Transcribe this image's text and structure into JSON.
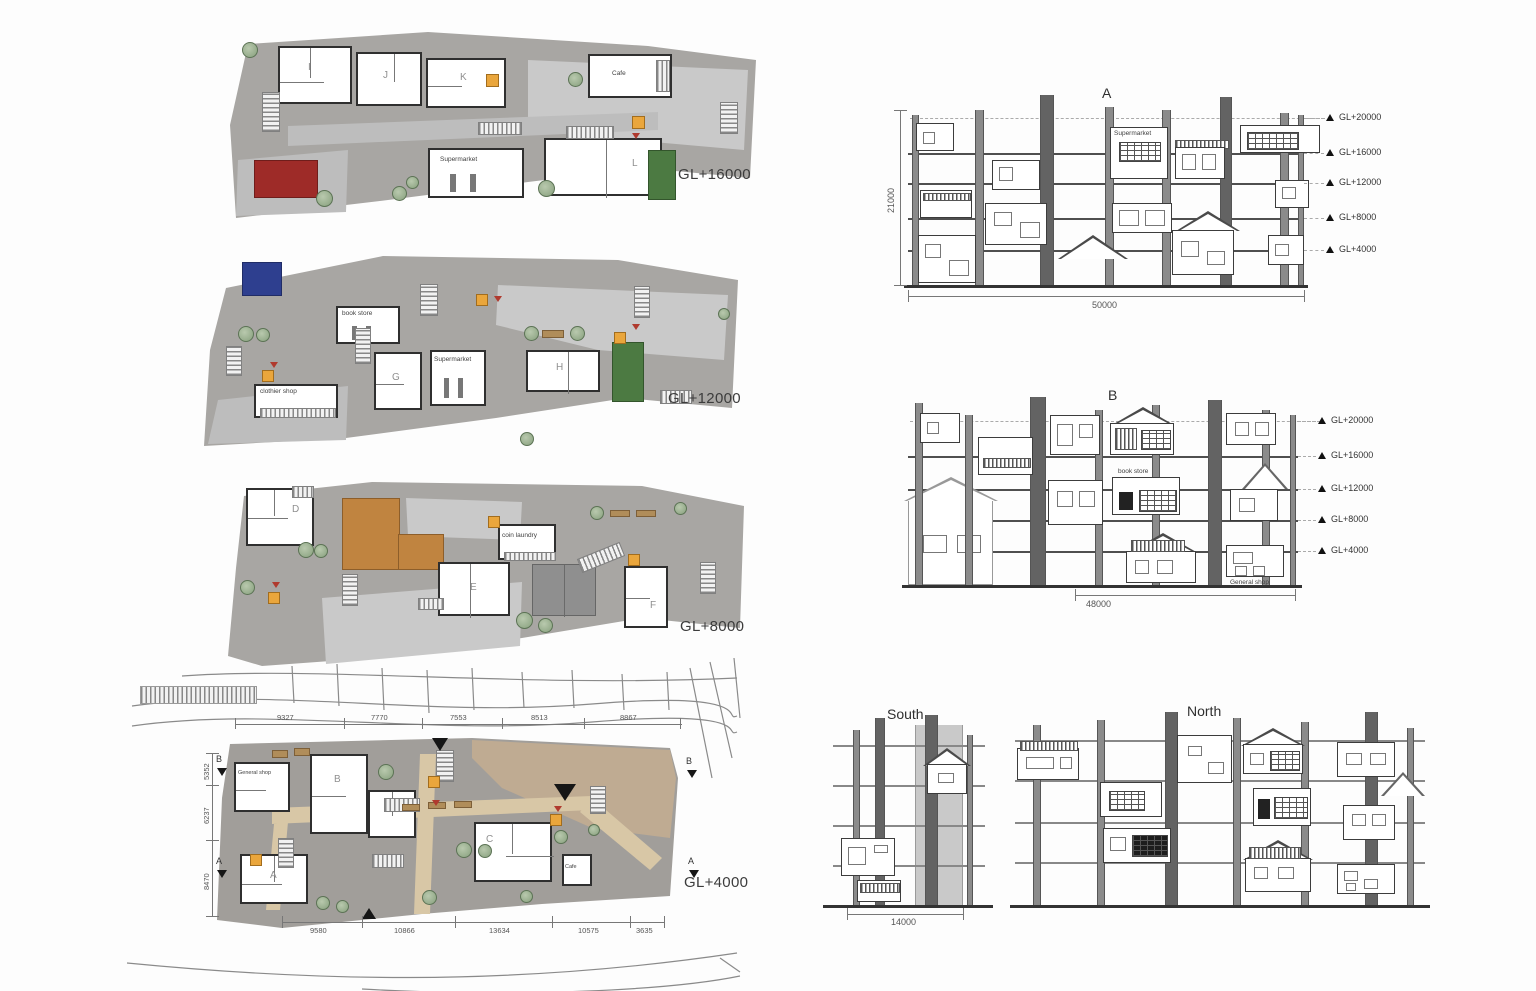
{
  "plans": {
    "gl16000": {
      "label": "GL+16000",
      "units": [
        "I",
        "J",
        "K",
        "L"
      ],
      "cafe": "Cafe",
      "supermarket": "Supermarket"
    },
    "gl12000": {
      "label": "GL+12000",
      "units": [
        "G",
        "H"
      ],
      "supermarket": "Supermarket",
      "book_store": "book store",
      "shop": "clothier shop"
    },
    "gl8000": {
      "label": "GL+8000",
      "units": [
        "D",
        "E",
        "F"
      ],
      "laundry": "coin laundry"
    },
    "gl4000": {
      "label": "GL+4000",
      "units": [
        "A",
        "B",
        "C"
      ],
      "cafe": "Cafe",
      "shop": "General shop",
      "dims_top": [
        "9327",
        "7770",
        "7553",
        "8513",
        "8867"
      ],
      "dims_bottom": [
        "9580",
        "10866",
        "13634",
        "10575",
        "3635"
      ],
      "dims_left": [
        "5352",
        "6237",
        "8470"
      ],
      "markers": {
        "b": "B",
        "a": "A"
      }
    }
  },
  "sections": {
    "a": {
      "title": "A",
      "height_dim": "21000",
      "width_dim": "50000",
      "levels": [
        "GL+20000",
        "GL+16000",
        "GL+12000",
        "GL+8000",
        "GL+4000"
      ],
      "supermarket": "Supermarket"
    },
    "b": {
      "title": "B",
      "width_dim": "48000",
      "levels": [
        "GL+20000",
        "GL+16000",
        "GL+12000",
        "GL+8000",
        "GL+4000"
      ],
      "book_store": "book store",
      "general_shop": "General shop"
    }
  },
  "elevations": {
    "south": {
      "title": "South",
      "width_dim": "14000"
    },
    "north": {
      "title": "North"
    }
  },
  "colors": {
    "roof_red": "#9e2b28",
    "roof_blue": "#2e3f8f",
    "terrace_green": "#4c7a42",
    "roof_orange": "#c08440",
    "marker_yellow": "#eaa63c",
    "slab_gray": "#a8a6a3",
    "plaza_gray": "#c9c9c9",
    "path_tan": "#d8c7a6",
    "tree_green": "#87a07d",
    "line_dark": "#3c3c3c"
  }
}
